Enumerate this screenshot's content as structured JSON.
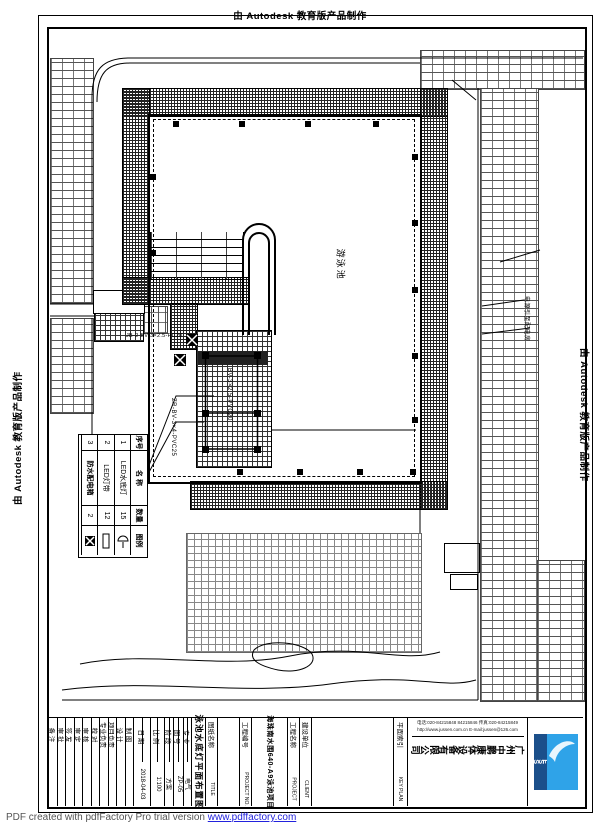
{
  "stamps": {
    "autodesk": "由 Autodesk 教育版产品制作"
  },
  "footer": {
    "pdf_note": "PDF created with pdfFactory Pro trial version ",
    "pdf_url": "www.pdffactory.com"
  },
  "drawing": {
    "pool_label": "游泳池",
    "annotations": {
      "box_circuit": "JB-2 BV-3×2.5-PC20",
      "cable_main": "BV-3×2.5-PVC20",
      "cable_left": "ZR-BV-3×4-PVC25",
      "power_note": "电源引至配电房"
    }
  },
  "legend": {
    "headers": [
      "序号",
      "名 称",
      "数量",
      "图例"
    ],
    "rows": [
      {
        "no": "1",
        "name": "LED水底灯",
        "qty": "15"
      },
      {
        "no": "2",
        "name": "LED灯带",
        "qty": "12"
      },
      {
        "no": "3",
        "name": "防水配电箱",
        "qty": "2"
      }
    ]
  },
  "titleblock": {
    "sig_labels": [
      "备 注",
      "审 批",
      "签 发",
      "审 定",
      "审 核",
      "校 对",
      "专业负责",
      "项目负责",
      "设 计",
      "制 图"
    ],
    "fields": [
      {
        "label": "日 期",
        "value": "2018-04-03"
      },
      {
        "label": "比 例",
        "value": "1:100"
      },
      {
        "label": "阶 段",
        "value": "方案"
      },
      {
        "label": "图 号",
        "value": "ZP-05"
      },
      {
        "label": "专 业",
        "value": "电气"
      }
    ],
    "drawing_title": "泳池水底灯平面布置图",
    "drawing_title_label": "图纸名称",
    "drawing_title_label_en": "TITLE",
    "project_no_label": "工程编号",
    "project_no_label_en": "PROJECT NO.",
    "project_name": "海珠南水围640-A9泳池项目",
    "project_label": "工程名称",
    "project_label_en": "PROJECT",
    "client_label": "建设单位",
    "client_label_en": "CLIENT",
    "keyplan_label": "平面索引",
    "keyplan_label_en": "KEY PLAN",
    "company": {
      "name": "广州中鹏康体设备有限公司",
      "contact1": "电话:020-84215848 84215846 传真:020-84215849",
      "contact2": "http://www.jussen.com.cn E-mail:jussen@126.com",
      "logo_text": "USSEN",
      "logo_band_color": "#1b4f8a",
      "logo_main_color": "#2fa3e8"
    }
  }
}
